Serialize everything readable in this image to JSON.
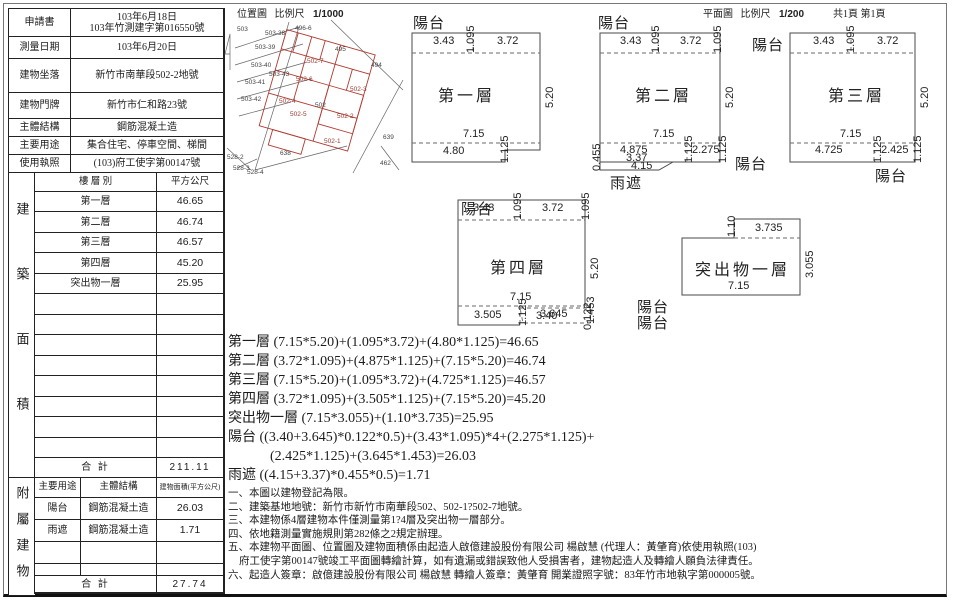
{
  "palette": {
    "ink": "#1c1c1c",
    "red_line": "#b03a30",
    "gray_line": "#555555"
  },
  "info_table": {
    "cells": [
      {
        "t": "申請書",
        "cls": "lab",
        "n": "info-label"
      },
      {
        "t": "103年6月18日\n103年竹測建字第016550號",
        "cls": "val",
        "n": "info-value"
      },
      {
        "t": "測量日期",
        "cls": "lab",
        "n": "info-label"
      },
      {
        "t": "103年6月20日",
        "cls": "val",
        "n": "info-value"
      },
      {
        "t": "建物坐落",
        "cls": "lab",
        "n": "info-label"
      },
      {
        "t": "新竹市南華段502-2地號",
        "cls": "val",
        "n": "info-value"
      },
      {
        "t": "建物門牌",
        "cls": "lab",
        "n": "info-label"
      },
      {
        "t": "新竹市仁和路23號",
        "cls": "val",
        "n": "info-value"
      },
      {
        "t": "主體結構",
        "cls": "lab",
        "n": "info-label"
      },
      {
        "t": "鋼筋混凝土造",
        "cls": "val",
        "n": "info-value"
      },
      {
        "t": "主要用途",
        "cls": "lab",
        "n": "info-label"
      },
      {
        "t": "集合住宅、停車空間、梯間",
        "cls": "val",
        "n": "info-value"
      },
      {
        "t": "使用執照",
        "cls": "lab",
        "n": "info-label"
      },
      {
        "t": "(103)府工使字第00147號",
        "cls": "val",
        "n": "info-value"
      }
    ]
  },
  "area_table": {
    "side_label": "建築面積",
    "cells": [
      {
        "t": "樓 層 別",
        "cls": "hd",
        "n": "col-header"
      },
      {
        "t": "平方公尺",
        "cls": "hd",
        "n": "col-header"
      },
      {
        "t": "第一層",
        "n": "floor-name"
      },
      {
        "t": "46.65",
        "cls": "num",
        "n": "floor-area"
      },
      {
        "t": "第二層",
        "n": "floor-name"
      },
      {
        "t": "46.74",
        "cls": "num",
        "n": "floor-area"
      },
      {
        "t": "第三層",
        "n": "floor-name"
      },
      {
        "t": "46.57",
        "cls": "num",
        "n": "floor-area"
      },
      {
        "t": "第四層",
        "n": "floor-name"
      },
      {
        "t": "45.20",
        "cls": "num",
        "n": "floor-area"
      },
      {
        "t": "突出物一層",
        "n": "floor-name"
      },
      {
        "t": "25.95",
        "cls": "num",
        "n": "floor-area"
      },
      {
        "t": ""
      },
      {
        "t": ""
      },
      {
        "t": ""
      },
      {
        "t": ""
      },
      {
        "t": ""
      },
      {
        "t": ""
      },
      {
        "t": ""
      },
      {
        "t": ""
      },
      {
        "t": ""
      },
      {
        "t": ""
      },
      {
        "t": ""
      },
      {
        "t": ""
      },
      {
        "t": ""
      },
      {
        "t": ""
      },
      {
        "t": ""
      },
      {
        "t": ""
      },
      {
        "t": "合  計",
        "cls": "tot",
        "n": "total-label"
      },
      {
        "t": "211.11",
        "cls": "num tot",
        "n": "total-value"
      }
    ]
  },
  "attached_table": {
    "side_label": "附屬建物",
    "cells": [
      {
        "t": "主要用途",
        "cls": "hd",
        "n": "col-header"
      },
      {
        "t": "主體結構",
        "cls": "hd",
        "n": "col-header"
      },
      {
        "t": "建物面積(平方公尺)",
        "cls": "hd tiny",
        "n": "col-header"
      },
      {
        "t": "陽台",
        "n": "attached-name"
      },
      {
        "t": "鋼筋混凝土造",
        "n": "attached-structure"
      },
      {
        "t": "26.03",
        "cls": "num",
        "n": "attached-area"
      },
      {
        "t": "雨遮",
        "n": "attached-name"
      },
      {
        "t": "鋼筋混凝土造",
        "n": "attached-structure"
      },
      {
        "t": "1.71",
        "cls": "num",
        "n": "attached-area"
      },
      {
        "t": ""
      },
      {
        "t": ""
      },
      {
        "t": ""
      },
      {
        "t": ""
      },
      {
        "t": ""
      },
      {
        "t": ""
      },
      {
        "t": "合  計",
        "cls": "tot span2",
        "n": "total-label"
      },
      {
        "t": "27.74",
        "cls": "num tot",
        "n": "total-value"
      }
    ]
  },
  "location_header": {
    "title": "位置圖",
    "scale_label": "比例尺",
    "scale": "1/1000"
  },
  "plan_header": {
    "title": "平面圖",
    "scale_label": "比例尺",
    "scale": "1/200",
    "pages": "共1頁 第1頁"
  },
  "location_map": {
    "labels": [
      {
        "t": "503",
        "x": 12,
        "y": 8,
        "cls": "mp"
      },
      {
        "t": "503-38",
        "x": 40,
        "y": 12,
        "cls": "mp"
      },
      {
        "t": "496-6",
        "x": 70,
        "y": 7,
        "cls": "mp"
      },
      {
        "t": "503-39",
        "x": 30,
        "y": 26,
        "cls": "mp"
      },
      {
        "t": "503-40",
        "x": 26,
        "y": 44,
        "cls": "mp"
      },
      {
        "t": "503-43",
        "x": 44,
        "y": 53,
        "cls": "mp"
      },
      {
        "t": "503-41",
        "x": 20,
        "y": 61,
        "cls": "mp"
      },
      {
        "t": "503-42",
        "x": 16,
        "y": 78,
        "cls": "mp"
      },
      {
        "t": "495",
        "x": 110,
        "y": 28,
        "cls": "mp"
      },
      {
        "t": "494",
        "x": 146,
        "y": 44,
        "cls": "mp"
      },
      {
        "t": "502-7",
        "x": 82,
        "y": 40,
        "cls": "mp mpr"
      },
      {
        "t": "502-6",
        "x": 71,
        "y": 58,
        "cls": "mp mpr"
      },
      {
        "t": "502-3",
        "x": 125,
        "y": 68,
        "cls": "mp mpr"
      },
      {
        "t": "502",
        "x": 90,
        "y": 84,
        "cls": "mp"
      },
      {
        "t": "502-4",
        "x": 54,
        "y": 80,
        "cls": "mp mpr"
      },
      {
        "t": "502-5",
        "x": 65,
        "y": 93,
        "cls": "mp mpr"
      },
      {
        "t": "502-2",
        "x": 112,
        "y": 95,
        "cls": "mp mpr"
      },
      {
        "t": "502-1",
        "x": 99,
        "y": 120,
        "cls": "mp mpr"
      },
      {
        "t": "639",
        "x": 158,
        "y": 116,
        "cls": "mp"
      },
      {
        "t": "638",
        "x": 55,
        "y": 132,
        "cls": "mp"
      },
      {
        "t": "462",
        "x": 155,
        "y": 142,
        "cls": "mp"
      },
      {
        "t": "528-2",
        "x": 2,
        "y": 136,
        "cls": "mp"
      },
      {
        "t": "528-3",
        "x": 8,
        "y": 147,
        "cls": "mp"
      },
      {
        "t": "528-4",
        "x": 22,
        "y": 151,
        "cls": "mp"
      }
    ]
  },
  "plans": {
    "p1": {
      "labels": [
        {
          "t": "陽台",
          "x": 8,
          "y": -10,
          "cls": "ann"
        },
        {
          "t": "3.43",
          "x": 28,
          "y": 13
        },
        {
          "t": "1.095",
          "x": 60,
          "y": 31,
          "v": 1
        },
        {
          "t": "3.72",
          "x": 92,
          "y": 13
        },
        {
          "t": "第一層",
          "x": 33,
          "y": 60,
          "cls": "floor"
        },
        {
          "t": "5.20",
          "x": 139,
          "y": 86,
          "v": 1
        },
        {
          "t": "7.15",
          "x": 58,
          "y": 106
        },
        {
          "t": "1.125",
          "x": 94,
          "y": 141,
          "v": 1
        },
        {
          "t": "4.80",
          "x": 38,
          "y": 123
        }
      ]
    },
    "p2": {
      "labels": [
        {
          "t": "陽台",
          "x": 0,
          "y": -10,
          "cls": "ann"
        },
        {
          "t": "3.43",
          "x": 22,
          "y": 13
        },
        {
          "t": "1.095",
          "x": 52,
          "y": 31,
          "v": 1
        },
        {
          "t": "3.72",
          "x": 82,
          "y": 13
        },
        {
          "t": "1.095",
          "x": 114,
          "y": 31,
          "v": 1
        },
        {
          "t": "第二層",
          "x": 37,
          "y": 60,
          "cls": "floor"
        },
        {
          "t": "5.20",
          "x": 126,
          "y": 86,
          "v": 1
        },
        {
          "t": "7.15",
          "x": 55,
          "y": 106
        },
        {
          "t": "1.125",
          "x": 85,
          "y": 141,
          "v": 1
        },
        {
          "t": "4.875",
          "x": 22,
          "y": 122
        },
        {
          "t": "3.37",
          "x": 28,
          "y": 130
        },
        {
          "t": "4.15",
          "x": 33,
          "y": 138
        },
        {
          "t": "0.455",
          "x": -7,
          "y": 149,
          "v": 1
        },
        {
          "t": "2.275",
          "x": 94,
          "y": 122
        },
        {
          "t": "1.125",
          "x": 119,
          "y": 141,
          "v": 1
        },
        {
          "t": "雨遮",
          "x": 12,
          "y": 150,
          "cls": "ann"
        },
        {
          "t": "陽台",
          "x": 137,
          "y": 131,
          "cls": "ann"
        },
        {
          "t": "陽台",
          "x": 154,
          "y": 12,
          "cls": "ann"
        }
      ]
    },
    "p3": {
      "labels": [
        {
          "t": "3.43",
          "x": 38,
          "y": 13
        },
        {
          "t": "1.095",
          "x": 70,
          "y": 31,
          "v": 1
        },
        {
          "t": "3.72",
          "x": 102,
          "y": 13
        },
        {
          "t": "第三層",
          "x": 53,
          "y": 60,
          "cls": "floor"
        },
        {
          "t": "5.20",
          "x": 144,
          "y": 86,
          "v": 1
        },
        {
          "t": "7.15",
          "x": 65,
          "y": 106
        },
        {
          "t": "1.125",
          "x": 97,
          "y": 141,
          "v": 1
        },
        {
          "t": "4.725",
          "x": 40,
          "y": 122
        },
        {
          "t": "2.425",
          "x": 106,
          "y": 122
        },
        {
          "t": "1.125",
          "x": 137,
          "y": 141,
          "v": 1
        },
        {
          "t": "陽台",
          "x": 100,
          "y": 143,
          "cls": "ann"
        }
      ]
    },
    "p4": {
      "labels": [
        {
          "t": "陽台",
          "x": 11,
          "y": 8,
          "cls": "ann"
        },
        {
          "t": "3.43",
          "x": 23,
          "y": 12
        },
        {
          "t": "1.095",
          "x": 62,
          "y": 30,
          "v": 1
        },
        {
          "t": "3.72",
          "x": 92,
          "y": 12
        },
        {
          "t": "1.095",
          "x": 130,
          "y": 30,
          "v": 1
        },
        {
          "t": "第四層",
          "x": 40,
          "y": 64,
          "cls": "floor"
        },
        {
          "t": "5.20",
          "x": 139,
          "y": 89,
          "v": 1
        },
        {
          "t": "7.15",
          "x": 60,
          "y": 101
        },
        {
          "t": "1.125",
          "x": 67,
          "y": 136,
          "v": 1
        },
        {
          "t": "3.505",
          "x": 24,
          "y": 119
        },
        {
          "t": "3.40",
          "x": 86,
          "y": 120
        },
        {
          "t": "3.645",
          "x": 90,
          "y": 118
        },
        {
          "t": "1.453",
          "x": 135,
          "y": 134,
          "v": 1
        },
        {
          "t": "0.122",
          "x": 132,
          "y": 140,
          "v": 1
        },
        {
          "t": "陽台",
          "x": 187,
          "y": 106,
          "cls": "ann"
        },
        {
          "t": "陽台",
          "x": 187,
          "y": 122,
          "cls": "ann"
        }
      ]
    },
    "pt": {
      "labels": [
        {
          "t": "1.10",
          "x": 56,
          "y": 32,
          "v": 1
        },
        {
          "t": "3.735",
          "x": 85,
          "y": 17
        },
        {
          "t": "突出物一層",
          "x": 25,
          "y": 51,
          "cls": "floor"
        },
        {
          "t": "3.055",
          "x": 134,
          "y": 73,
          "v": 1
        },
        {
          "t": "7.15",
          "x": 58,
          "y": 75
        }
      ]
    }
  },
  "formulas": [
    {
      "t": "第一層 (7.15*5.20)+(1.095*3.72)+(4.80*1.125)=46.65"
    },
    {
      "t": "第二層 (3.72*1.095)+(4.875*1.125)+(7.15*5.20)=46.74"
    },
    {
      "t": "第三層 (7.15*5.20)+(1.095*3.72)+(4.725*1.125)=46.57"
    },
    {
      "t": "第四層 (3.72*1.095)+(3.505*1.125)+(7.15*5.20)=45.20"
    },
    {
      "t": "突出物一層 (7.15*3.055)+(1.10*3.735)=25.95"
    },
    {
      "t": "陽台 ((3.40+3.645)*0.122*0.5)+(3.43*1.095)*4+(2.275*1.125)+"
    },
    {
      "t": "(2.425*1.125)+(3.645*1.453)=26.03",
      "cls": "ind"
    },
    {
      "t": "雨遮 ((4.15+3.37)*0.455*0.5)=1.71"
    }
  ],
  "notes": [
    {
      "t": "一、本圖以建物登記為限。"
    },
    {
      "t": "二、建築基地地號：新竹市新竹市南華段502、502-1?502-7地號。"
    },
    {
      "t": "三、本建物係4層建物本件僅測量第1?4層及突出物一層部分。"
    },
    {
      "t": "四、依地籍測量實施規則第282條之2規定辦理。"
    },
    {
      "t": "五、本建物平面圖、位置圖及建物面積係由起造人啟億建設股份有限公司 楊啟慧 (代理人：黃肇育)依使用執照(103)"
    },
    {
      "t": "府工使字第00147號竣工平面圖轉繪計算，如有遺漏或錯誤致他人受損害者，建物起造人及轉繪人願負法律責任。",
      "cls": "ind1"
    },
    {
      "t": "六、起造人簽章：啟億建設股份有限公司 楊啟慧  轉繪人簽章：黃肇育 開業證照字號：83年竹市地執字第000005號。"
    }
  ]
}
